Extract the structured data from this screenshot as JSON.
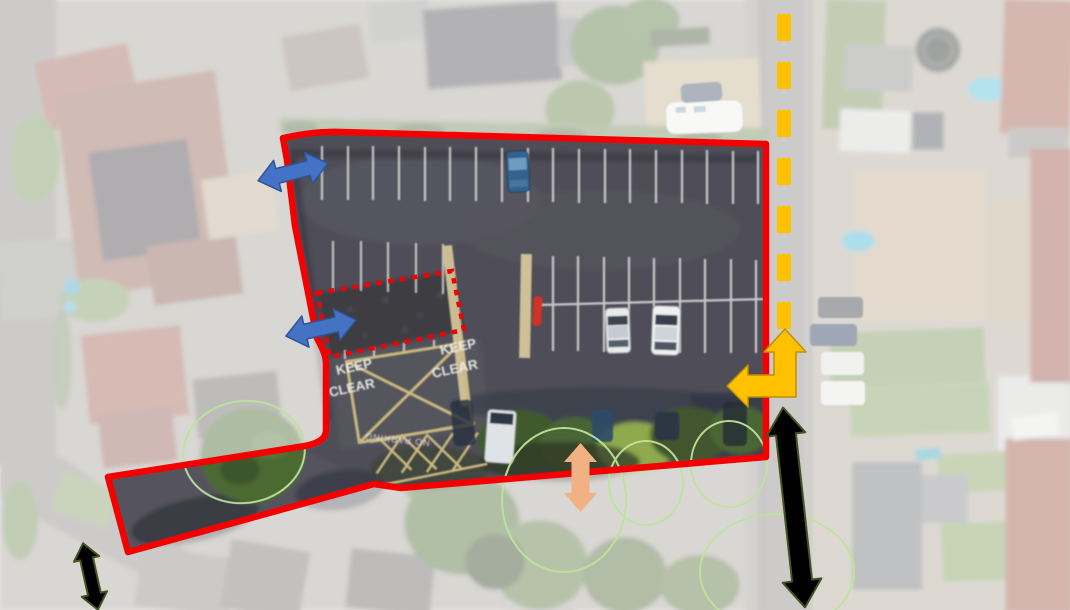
{
  "scene": {
    "description": "Aerial photograph site plan of a car park, surroundings faded white, with planning annotations",
    "fade_color": "#FFFFFF"
  },
  "road_markings": {
    "keep_clear_left": {
      "line1": "KEEP",
      "line2": "CLEAR"
    },
    "keep_clear_right": {
      "line1": "KEEP",
      "line2": "CLEAR"
    },
    "no_parking": "NO PARKING"
  },
  "annotations": {
    "site_boundary": {
      "label": "site boundary",
      "color": "#F40000",
      "style": "solid"
    },
    "sub_area": {
      "label": "hatched sub-area outline",
      "color": "#F40000",
      "style": "dotted"
    },
    "route_line": {
      "label": "route along adjacent road",
      "color": "#FFC000",
      "style": "dashed"
    },
    "turn_arrow": {
      "label": "turn-in arrow up-and-left",
      "color": "#FFC000",
      "outline": "#BF9000"
    },
    "blue_arrows": {
      "label": "access double-headed arrows",
      "color": "#4472C4",
      "outline": "#2F5597",
      "count": 2
    },
    "green_arrows": {
      "label": "movement double-headed arrows",
      "color": "#A9D18E",
      "outline": "#44541F",
      "count": 2
    },
    "peach_arrow": {
      "label": "connection double-headed arrow",
      "color": "#F2B183"
    },
    "tree_circles": {
      "label": "tree canopy markers",
      "color": "#BEE39B",
      "count": 5
    }
  }
}
